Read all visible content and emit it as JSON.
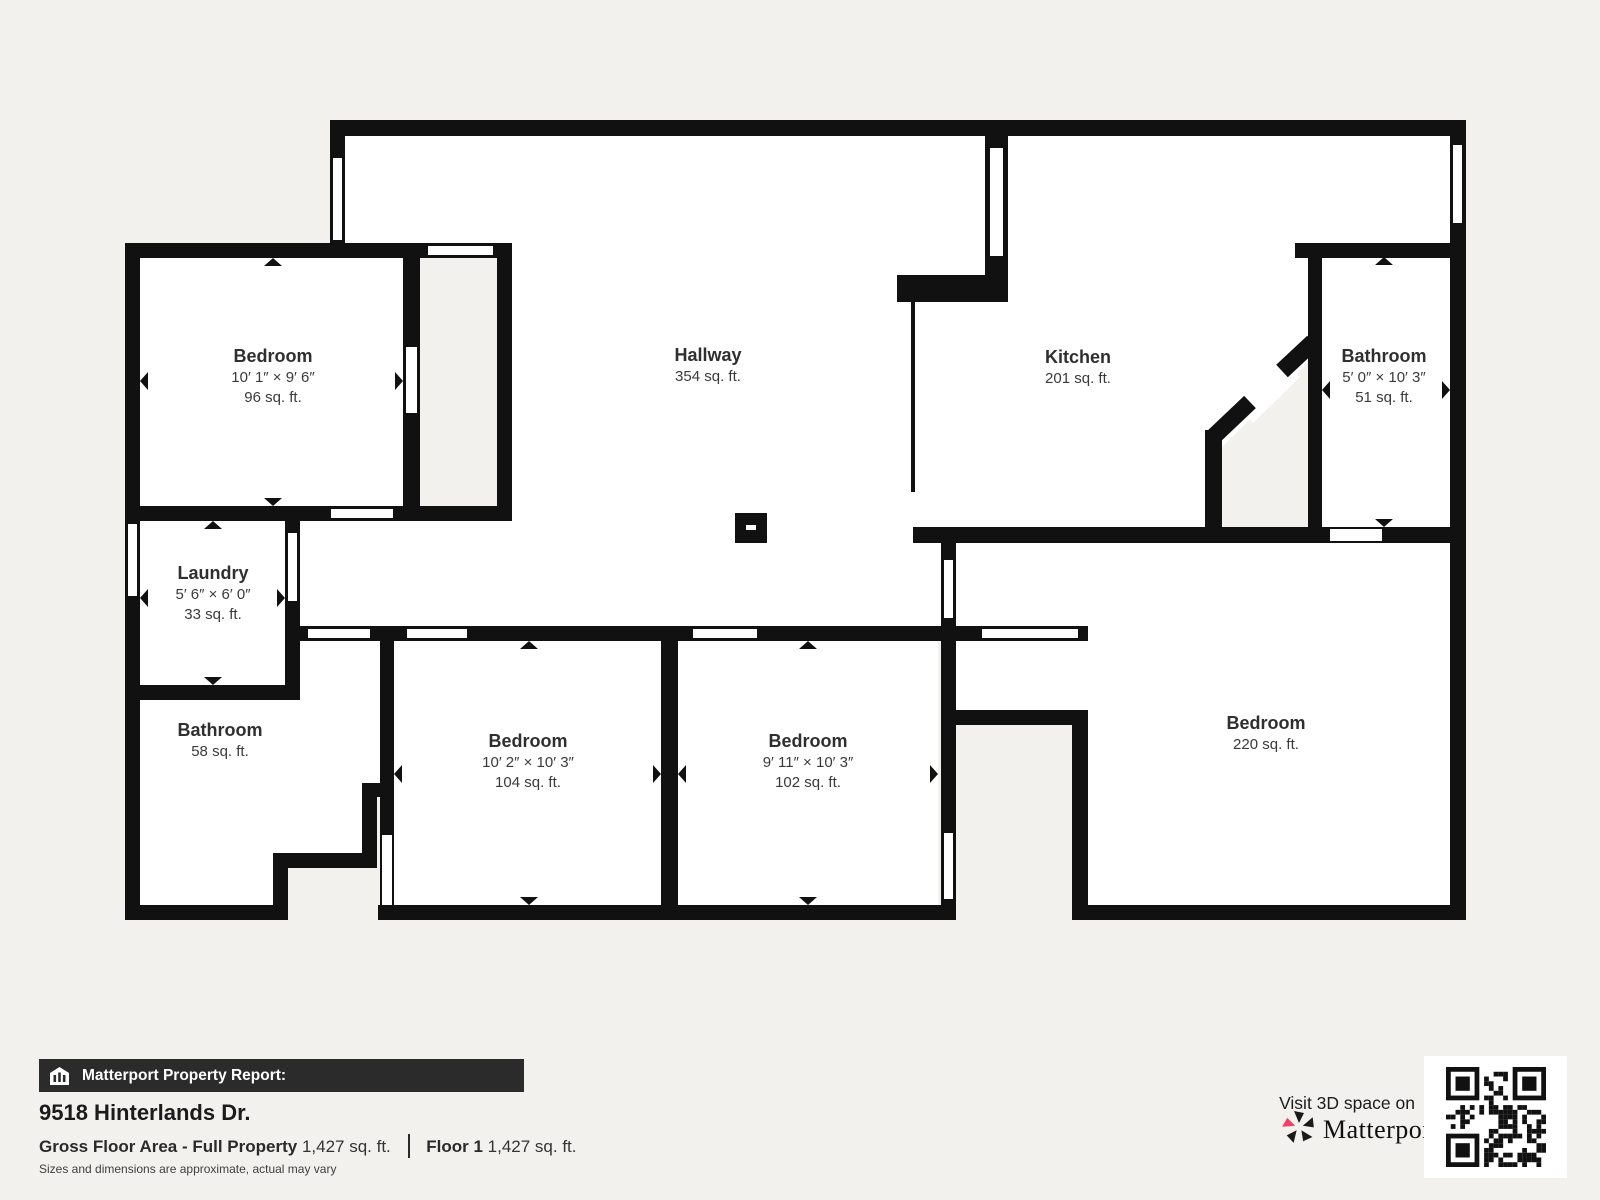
{
  "page": {
    "background_color": "#f2f1ee",
    "wall_color": "#111111",
    "floor_color": "#ffffff",
    "accent_pink": "#f43e63"
  },
  "rooms": [
    {
      "name": "Bedroom",
      "dims": "10′ 1″ × 9′ 6″",
      "area": "96 sq. ft."
    },
    {
      "name": "Hallway",
      "area": "354 sq. ft."
    },
    {
      "name": "Kitchen",
      "area": "201 sq. ft."
    },
    {
      "name": "Bathroom",
      "dims": "5′ 0″ × 10′ 3″",
      "area": "51 sq. ft."
    },
    {
      "name": "Laundry",
      "dims": "5′ 6″ × 6′ 0″",
      "area": "33 sq. ft."
    },
    {
      "name": "Bathroom",
      "area": "58 sq. ft."
    },
    {
      "name": "Bedroom",
      "dims": "10′ 2″ × 10′ 3″",
      "area": "104 sq. ft."
    },
    {
      "name": "Bedroom",
      "dims": "9′ 11″ × 10′ 3″",
      "area": "102 sq. ft."
    },
    {
      "name": "Bedroom",
      "area": "220 sq. ft."
    }
  ],
  "footer": {
    "report_label": "Matterport Property Report:",
    "report_icon": "building-icon",
    "address": "9518 Hinterlands Dr.",
    "gross_label": "Gross Floor Area - Full Property",
    "gross_value": "1,427 sq. ft.",
    "floor_label": "Floor 1",
    "floor_value": "1,427 sq. ft.",
    "disclaimer": "Sizes and dimensions are approximate, actual may vary"
  },
  "cta": {
    "visit_text": "Visit 3D space on",
    "brand": "Matterport",
    "brand_mark": "®",
    "logo_icon": "matterport-pinwheel-icon",
    "qr_icon": "qr-code"
  }
}
